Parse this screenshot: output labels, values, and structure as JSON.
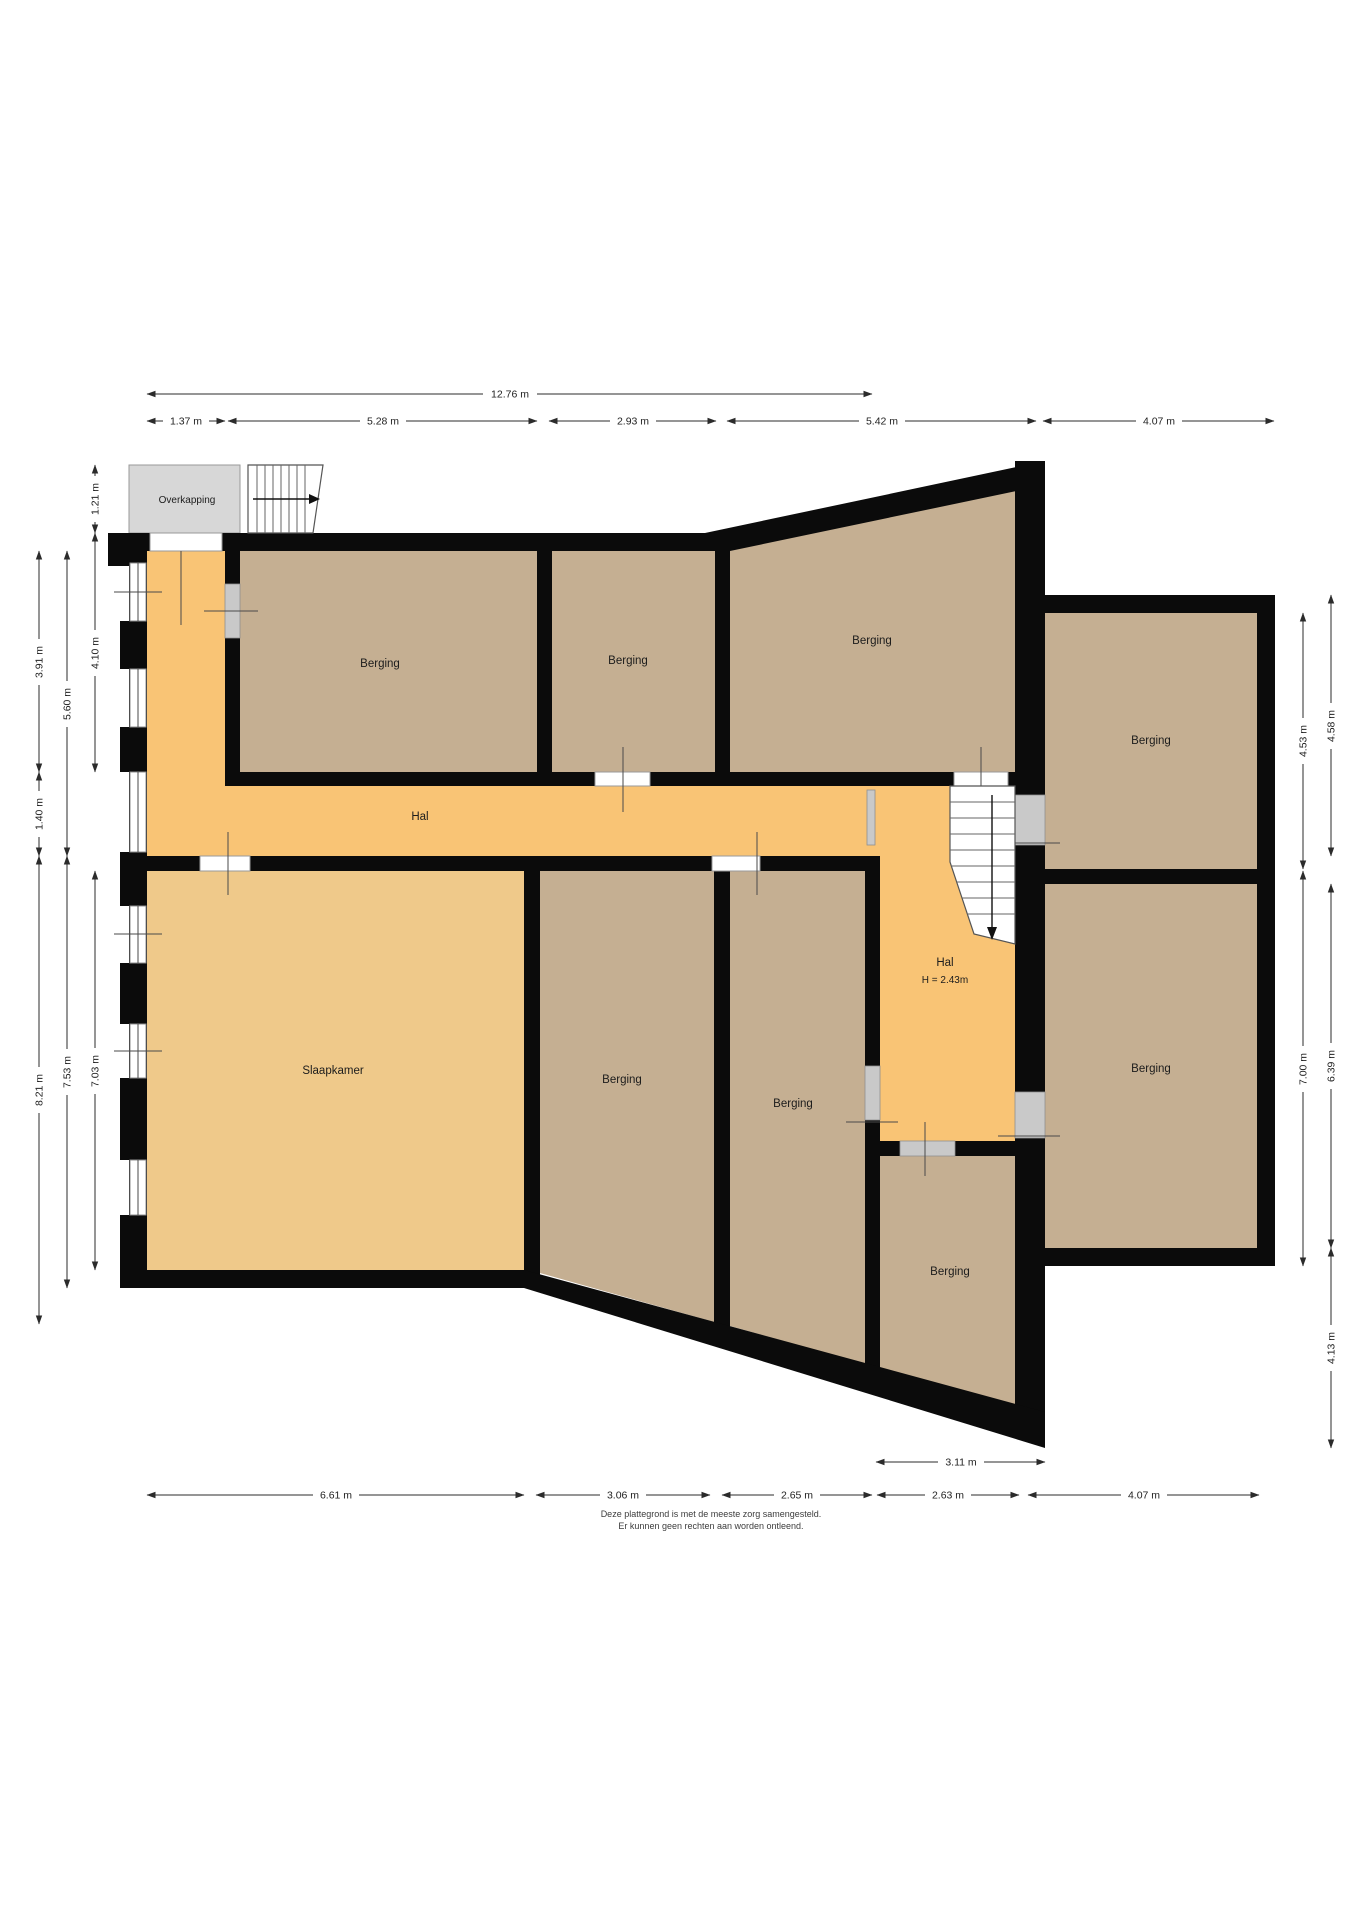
{
  "rooms": {
    "overkapping": {
      "label": "Overkapping"
    },
    "hal_main": {
      "label": "Hal"
    },
    "hal_right": {
      "label": "Hal",
      "height_note": "H = 2.43m"
    },
    "slaapkamer": {
      "label": "Slaapkamer"
    },
    "berging_top_left": {
      "label": "Berging"
    },
    "berging_top_mid": {
      "label": "Berging"
    },
    "berging_top_right": {
      "label": "Berging"
    },
    "berging_right_upper": {
      "label": "Berging"
    },
    "berging_right_lower": {
      "label": "Berging"
    },
    "berging_bottom_left": {
      "label": "Berging"
    },
    "berging_bottom_mid": {
      "label": "Berging"
    },
    "berging_bottom_right": {
      "label": "Berging"
    }
  },
  "dimensions": {
    "top_total": "12.76 m",
    "top_row": [
      "1.37 m",
      "5.28 m",
      "2.93 m",
      "5.42 m",
      "4.07 m"
    ],
    "bottom_row": [
      "6.61 m",
      "3.06 m",
      "2.65 m",
      "2.63 m",
      "4.07 m"
    ],
    "bottom_inner": "3.11 m",
    "left_inner": [
      "1.21 m",
      "4.10 m",
      "7.03 m"
    ],
    "left_middle": [
      "5.60 m",
      "7.53 m"
    ],
    "left_outer": [
      "3.91 m",
      "1.40 m",
      "8.21 m"
    ],
    "right_inner": [
      "4.53 m",
      "7.00 m"
    ],
    "right_outer": [
      "4.58 m",
      "6.39 m",
      "4.13 m"
    ]
  },
  "disclaimer": {
    "line1": "Deze plattegrond is met de meeste zorg samengesteld.",
    "line2": "Er kunnen geen rechten aan worden ontleend."
  },
  "colors": {
    "hal": "#F9C475",
    "slaapkamer": "#EFC98A",
    "berging": "#C5AF92",
    "overkapping": "#D7D7D7",
    "wall": "#0B0B0B"
  }
}
